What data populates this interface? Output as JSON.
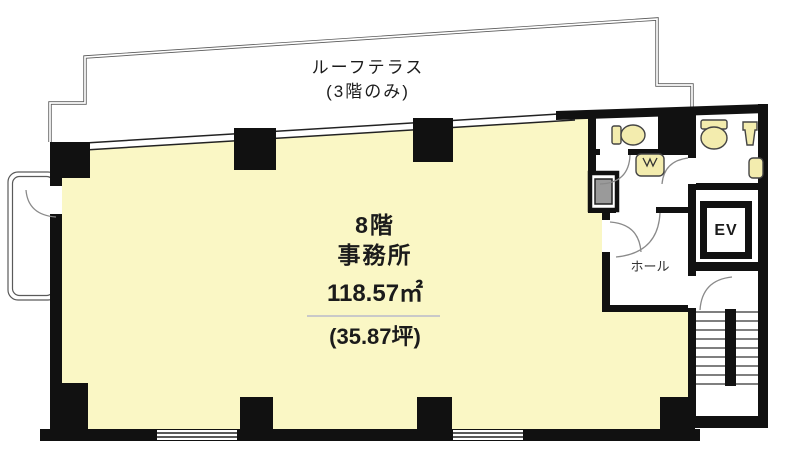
{
  "labels": {
    "terrace_line1": "ルーフテラス",
    "terrace_line2": "(3階のみ)",
    "floor": "8階",
    "use": "事務所",
    "area_m2": "118.57㎡",
    "area_tsubo": "(35.87坪)",
    "elevator": "EV",
    "hall": "ホール"
  },
  "colors": {
    "office_fill": "#FAF7C5",
    "fixture_fill": "#F3ECAE",
    "wall": "#111111",
    "terrace_line": "#5a5a5a",
    "door_arc": "#8a8a8a"
  }
}
